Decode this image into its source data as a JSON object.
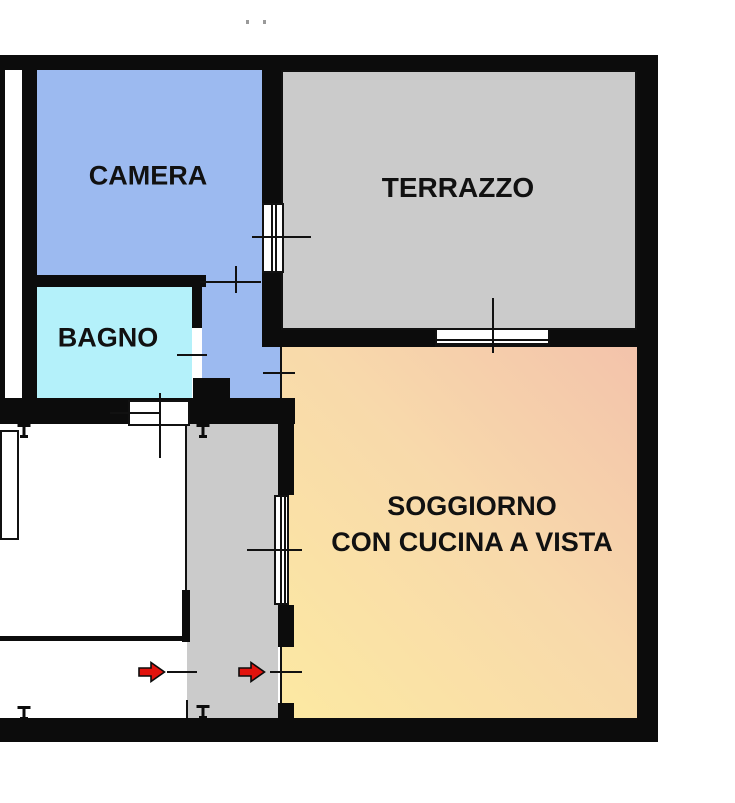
{
  "plan": {
    "type": "apartment-floor-plan",
    "rooms": {
      "camera": {
        "label": "CAMERA",
        "color": "#9cbaf0"
      },
      "terrazzo": {
        "label": "TERRAZZO",
        "color": "#cbcbcb"
      },
      "bagno": {
        "label": "BAGNO",
        "color": "#b4f1fa"
      },
      "soggiorno": {
        "label_line1": "SOGGIORNO",
        "label_line2": "CON CUCINA A VISTA",
        "gradient_from": "#fce9a2",
        "gradient_to": "#f3c3ab"
      },
      "corridor": {
        "color": "#9cbaf0"
      },
      "entrance_hall": {
        "color": "#cbcbcb"
      }
    },
    "annotations": {
      "wall_color": "#0c0c0c",
      "entrance_arrow_color": "#e2130d",
      "entrance_arrow_count": 2
    }
  }
}
